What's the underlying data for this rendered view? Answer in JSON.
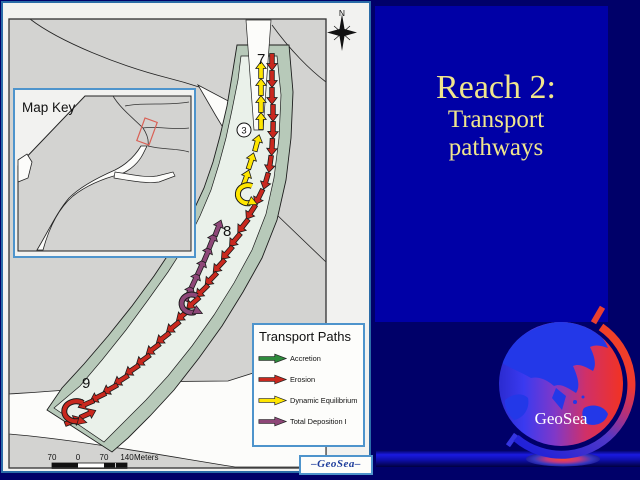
{
  "slide": {
    "background_color": "#000069",
    "accent_panel_color": "#0000A6",
    "title": {
      "line1": "Reach 2:",
      "line2": "Transport",
      "line3": "pathways",
      "color": "#F0E68C"
    }
  },
  "map": {
    "compass_label": "N",
    "inset": {
      "title": "Map Key"
    },
    "labels": {
      "station7": "7",
      "station3": "3",
      "station8": "8",
      "station9": "9"
    },
    "scale": {
      "tick1": "70",
      "tick2": "0",
      "tick3": "70",
      "tick4": "140",
      "unit": "Meters"
    },
    "legend": {
      "title": "Transport Paths",
      "items": [
        {
          "label": "Accretion",
          "color": "#2E8B3C"
        },
        {
          "label": "Erosion",
          "color": "#C9281E"
        },
        {
          "label": "Dynamic Equilibrium",
          "color": "#FFE600"
        },
        {
          "label": "Total Deposition I",
          "color": "#8E4778"
        }
      ]
    },
    "credit": "–GeoSea–",
    "arrows": [
      {
        "name": "erosion-path",
        "color": "#C9281E",
        "points": [
          [
            272,
            62,
            90
          ],
          [
            272,
            79,
            90
          ],
          [
            272,
            96,
            90
          ],
          [
            273,
            113,
            90
          ],
          [
            273,
            130,
            91
          ],
          [
            272,
            147,
            93
          ],
          [
            270,
            164,
            98
          ],
          [
            266,
            181,
            106
          ],
          [
            259,
            197,
            116
          ],
          [
            251,
            212,
            123
          ],
          [
            243,
            226,
            128
          ],
          [
            235,
            240,
            130
          ],
          [
            227,
            253,
            131
          ],
          [
            219,
            266,
            133
          ],
          [
            211,
            279,
            134
          ],
          [
            202,
            291,
            136
          ],
          [
            193,
            303,
            138
          ],
          [
            183,
            315,
            140
          ],
          [
            173,
            327,
            141
          ],
          [
            163,
            338,
            142
          ],
          [
            153,
            349,
            143
          ],
          [
            143,
            360,
            144
          ],
          [
            132,
            370,
            146
          ],
          [
            121,
            380,
            148
          ],
          [
            110,
            389,
            151
          ],
          [
            98,
            397,
            154
          ],
          [
            86,
            404,
            157
          ],
          [
            73,
            421,
            338
          ],
          [
            88,
            414,
            336
          ]
        ]
      },
      {
        "name": "dynamic-equilibrium-path",
        "color": "#FFE600",
        "points": [
          [
            261,
            70,
            270
          ],
          [
            261,
            87,
            270
          ],
          [
            261,
            104,
            270
          ],
          [
            261,
            121,
            270
          ],
          [
            257,
            143,
            285
          ],
          [
            251,
            161,
            288
          ],
          [
            246,
            178,
            290
          ]
        ]
      },
      {
        "name": "total-deposition-path",
        "color": "#8E4778",
        "points": [
          [
            189,
            293,
            295
          ],
          [
            195,
            280,
            295
          ],
          [
            201,
            267,
            294
          ],
          [
            207,
            254,
            293
          ],
          [
            212,
            241,
            292
          ],
          [
            218,
            228,
            291
          ]
        ]
      }
    ],
    "hooks": [
      {
        "color": "#C9281E",
        "d": "M 83,403 A 12,10 0 1 0 79,421",
        "end": [
          81,
          421,
          15
        ]
      },
      {
        "color": "#FFE600",
        "d": "M 252,186 A 10,9 0 1 0 250,203",
        "end": [
          252,
          202,
          25
        ]
      },
      {
        "color": "#8E4778",
        "d": "M 197,296 A 10,9 0 1 0 195,312",
        "end": [
          197,
          311,
          25
        ]
      }
    ]
  },
  "logo": {
    "label": "GeoSea"
  }
}
